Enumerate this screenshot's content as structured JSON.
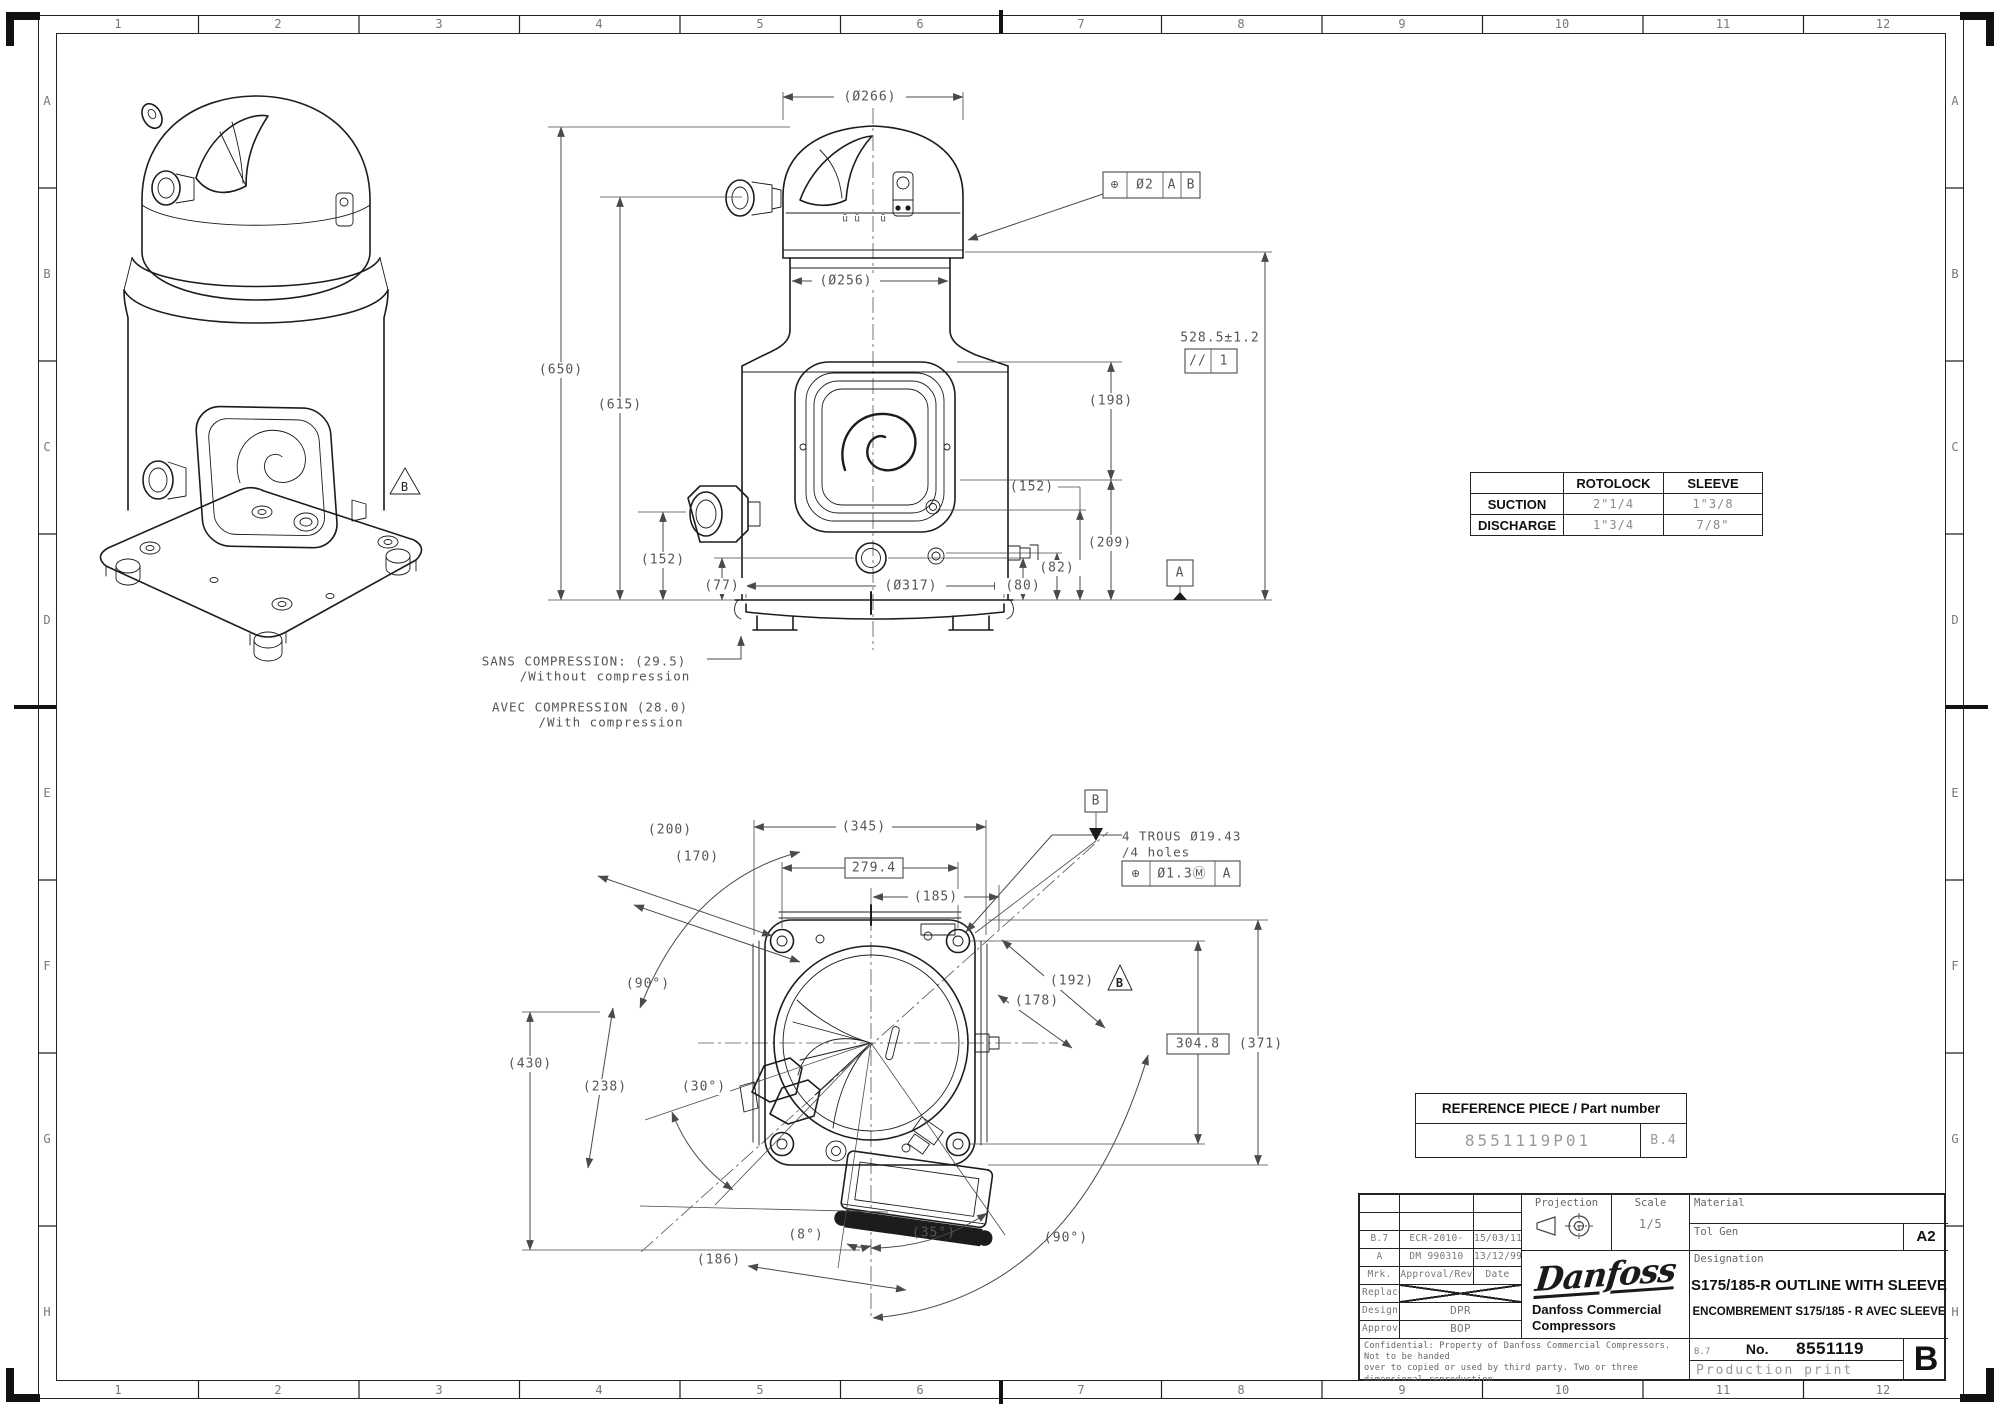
{
  "page": {
    "bg": "#ffffff",
    "line_color": "#1c1c1c",
    "dim_color": "#555555",
    "muted_color": "#8a8a8a"
  },
  "grid": {
    "columns": [
      "1",
      "2",
      "3",
      "4",
      "5",
      "6",
      "7",
      "8",
      "9",
      "10",
      "11",
      "12"
    ],
    "rows": [
      "A",
      "B",
      "C",
      "D",
      "E",
      "F",
      "G",
      "H"
    ]
  },
  "iso_view": {
    "flag_b": "B"
  },
  "front_view": {
    "dim_dia_top": "(Ø266)",
    "dim_dia_neck": "(Ø256)",
    "fcf_top": {
      "symbol": "⊕",
      "tolerance": "Ø2",
      "datum1": "A",
      "datum2": "B"
    },
    "dim_650": "(650)",
    "dim_615": "(615)",
    "dim_198": "(198)",
    "dim_209": "(209)",
    "dim_528": "528.5±1.2",
    "fcf_parallel": {
      "symbol": "//",
      "datum": "1"
    },
    "dim_152_right": "(152)",
    "dim_82": "(82)",
    "dim_80": "(80)",
    "dim_152_left": "(152)",
    "dim_77": "(77)",
    "dim_dia_base": "(Ø317)",
    "datum_a": "A",
    "weld_mark_1": "ū ū",
    "weld_mark_2": "ū",
    "note_sans_line1": "SANS COMPRESSION: (29.5)",
    "note_sans_line2": "/Without compression",
    "note_avec_line1": "AVEC COMPRESSION (28.0)",
    "note_avec_line2": "/With compression"
  },
  "bottom_view": {
    "dim_200": "(200)",
    "dim_170": "(170)",
    "dim_345": "(345)",
    "dim_279": "279.4",
    "dim_185": "(185)",
    "datum_b": "B",
    "holes_note_line1": "4 TROUS Ø19.43",
    "holes_note_line2": "/4 holes",
    "fcf_holes": {
      "symbol": "⊕",
      "tolerance": "Ø1.3Ⓜ",
      "datum": "A"
    },
    "angle_90_top": "(90°)",
    "dim_430": "(430)",
    "dim_238": "(238)",
    "angle_30": "(30°)",
    "dim_192": "(192)",
    "flag_b": "B",
    "dim_178": "(178)",
    "dim_304": "304.8",
    "dim_371": "(371)",
    "angle_8": "(8°)",
    "angle_35": "(35°)",
    "angle_90_bottom": "(90°)",
    "dim_186": "(186)"
  },
  "connection_table": {
    "col_headers": [
      "ROTOLOCK",
      "SLEEVE"
    ],
    "rows": [
      {
        "label": "SUCTION",
        "rotolock": "2\"1/4",
        "sleeve": "1\"3/8"
      },
      {
        "label": "DISCHARGE",
        "rotolock": "1\"3/4",
        "sleeve": "7/8\""
      }
    ]
  },
  "reference_table": {
    "header": "REFERENCE PIECE / Part number",
    "part_number": "8551119P01",
    "revision": "B.4"
  },
  "title_block": {
    "revision_history": [
      {
        "mrk": "B.7",
        "reference": "ECR-2010-2897",
        "date": "15/03/11"
      },
      {
        "mrk": "A",
        "reference": "DM 990310",
        "date": "13/12/99"
      }
    ],
    "rev_header": {
      "mrk": "Mrk.",
      "approval": "Approval/Rev",
      "date": "Date"
    },
    "replace_label": "Replace",
    "design_label": "Design",
    "design_value": "DPR",
    "approval_label": "Approval",
    "approval_value": "BOP",
    "confidential_line1": "Confidential: Property of Danfoss Commercial Compressors. Not to be handed",
    "confidential_line2": "over to copied or used by third party. Two or three dimensional reproduction",
    "confidential_line3": "of contents to be autorized by Danfoss CC.",
    "projection_label": "Projection",
    "scale_label": "Scale",
    "scale_value": "1/5",
    "material_label": "Material",
    "tol_gen_label": "Tol Gen",
    "format": "A2",
    "logo_text": "Danfoss",
    "company_line1": "Danfoss Commercial",
    "company_line2": "Compressors",
    "designation_label": "Designation",
    "designation_line1": "S175/185-R OUTLINE WITH SLEEVE",
    "designation_line2": "ENCOMBREMENT S175/185 - R AVEC SLEEVE",
    "no_prefix": "B.7",
    "no_label": "No.",
    "drawing_number": "8551119",
    "print_type": "Production print",
    "revision_letter": "B"
  }
}
